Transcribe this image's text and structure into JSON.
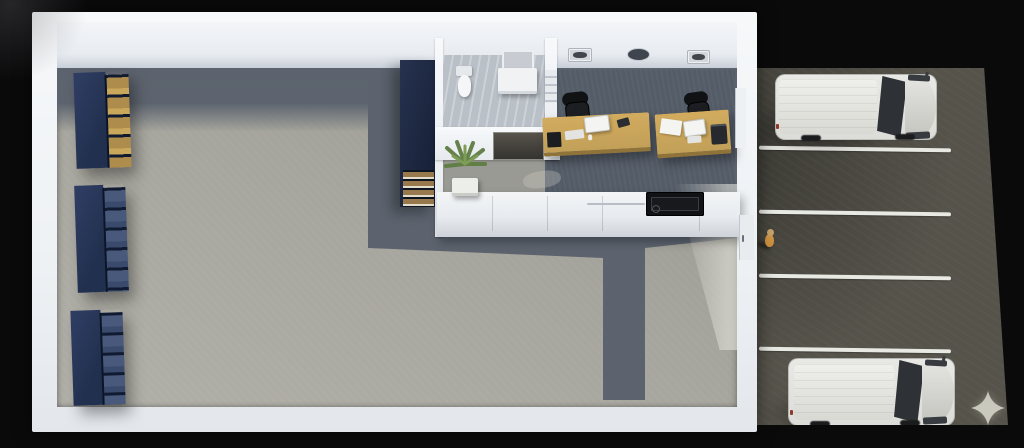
{
  "meta": {
    "kind": "3d-floorplan-render",
    "view": "top-down isometric cutaway",
    "subject": "warehouse with front office, reception counter and customer parking"
  },
  "colors": {
    "background": "#0a0a0b",
    "wall_white": "#f1f3f6",
    "warehouse_floor": "#a6a59d",
    "floor_shadow": "#5c636e",
    "office_carpet": "#545c68",
    "bathroom_floor": "#bac0c8",
    "rack_navy": "#22304f",
    "rack_items_gold": "#ae8c4b",
    "desk_wood": "#c2a058",
    "chair_black": "#1c1e21",
    "counter_white": "#ced3d9",
    "counter_panel_dark": "#17191c",
    "asphalt": "#55534a",
    "parking_line": "#e9e9e4",
    "van_white": "#dcdcd8",
    "van_glass": "#2e3237",
    "person_orange": "#cc8f3e",
    "plant_green": "#5f7d42",
    "door_dark": "#4a463f",
    "sparkle": "#cfcdc2"
  },
  "building": {
    "rooms": [
      "warehouse",
      "office",
      "bathroom",
      "reception"
    ],
    "warehouse": {
      "storage_racks": 3,
      "wall_cabinet": 1
    },
    "office": {
      "desks": 2,
      "chairs": 2,
      "monitors": 2,
      "keyboards": 2,
      "wall_items": [
        "air-vent",
        "wall-clock",
        "air-vent"
      ],
      "extras": [
        "papers",
        "desktop-pc",
        "printer",
        "wall-shelf"
      ]
    },
    "bathroom": {
      "fixtures": [
        "toilet",
        "vanity-sink",
        "mirror"
      ],
      "door": 1
    },
    "reception": {
      "counter_sections": 5,
      "dark_panel": 1,
      "plant": 1,
      "entry_door": 1
    }
  },
  "parking": {
    "stall_lines": 4,
    "vehicles": [
      {
        "type": "van",
        "color_name": "white",
        "position": "top stall"
      },
      {
        "type": "van",
        "color_name": "white",
        "position": "bottom stall"
      }
    ],
    "people": 1
  },
  "overlay": {
    "icon": "sparkle",
    "position": "bottom-right"
  }
}
